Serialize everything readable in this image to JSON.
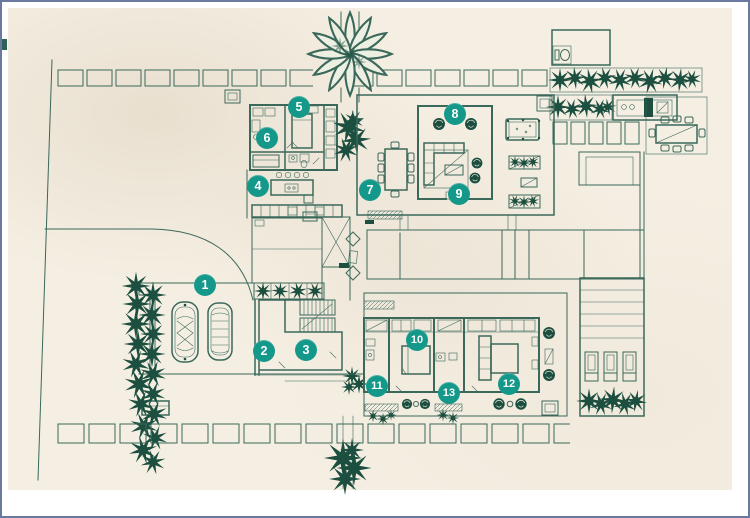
{
  "colors": {
    "badge_teal": "#13988a",
    "line_green": "#3a685a",
    "wall_green": "#2b584a",
    "plant_green": "#1d4f40",
    "paper_cream": "#f5efe3",
    "frame_blue": "#6a79a0",
    "margin_white": "#ffffff"
  },
  "badges": [
    {
      "label": "1"
    },
    {
      "label": "2"
    },
    {
      "label": "3"
    },
    {
      "label": "4"
    },
    {
      "label": "5"
    },
    {
      "label": "6"
    },
    {
      "label": "7"
    },
    {
      "label": "8"
    },
    {
      "label": "9"
    },
    {
      "label": "10"
    },
    {
      "label": "11"
    },
    {
      "label": "12"
    },
    {
      "label": "13"
    }
  ]
}
